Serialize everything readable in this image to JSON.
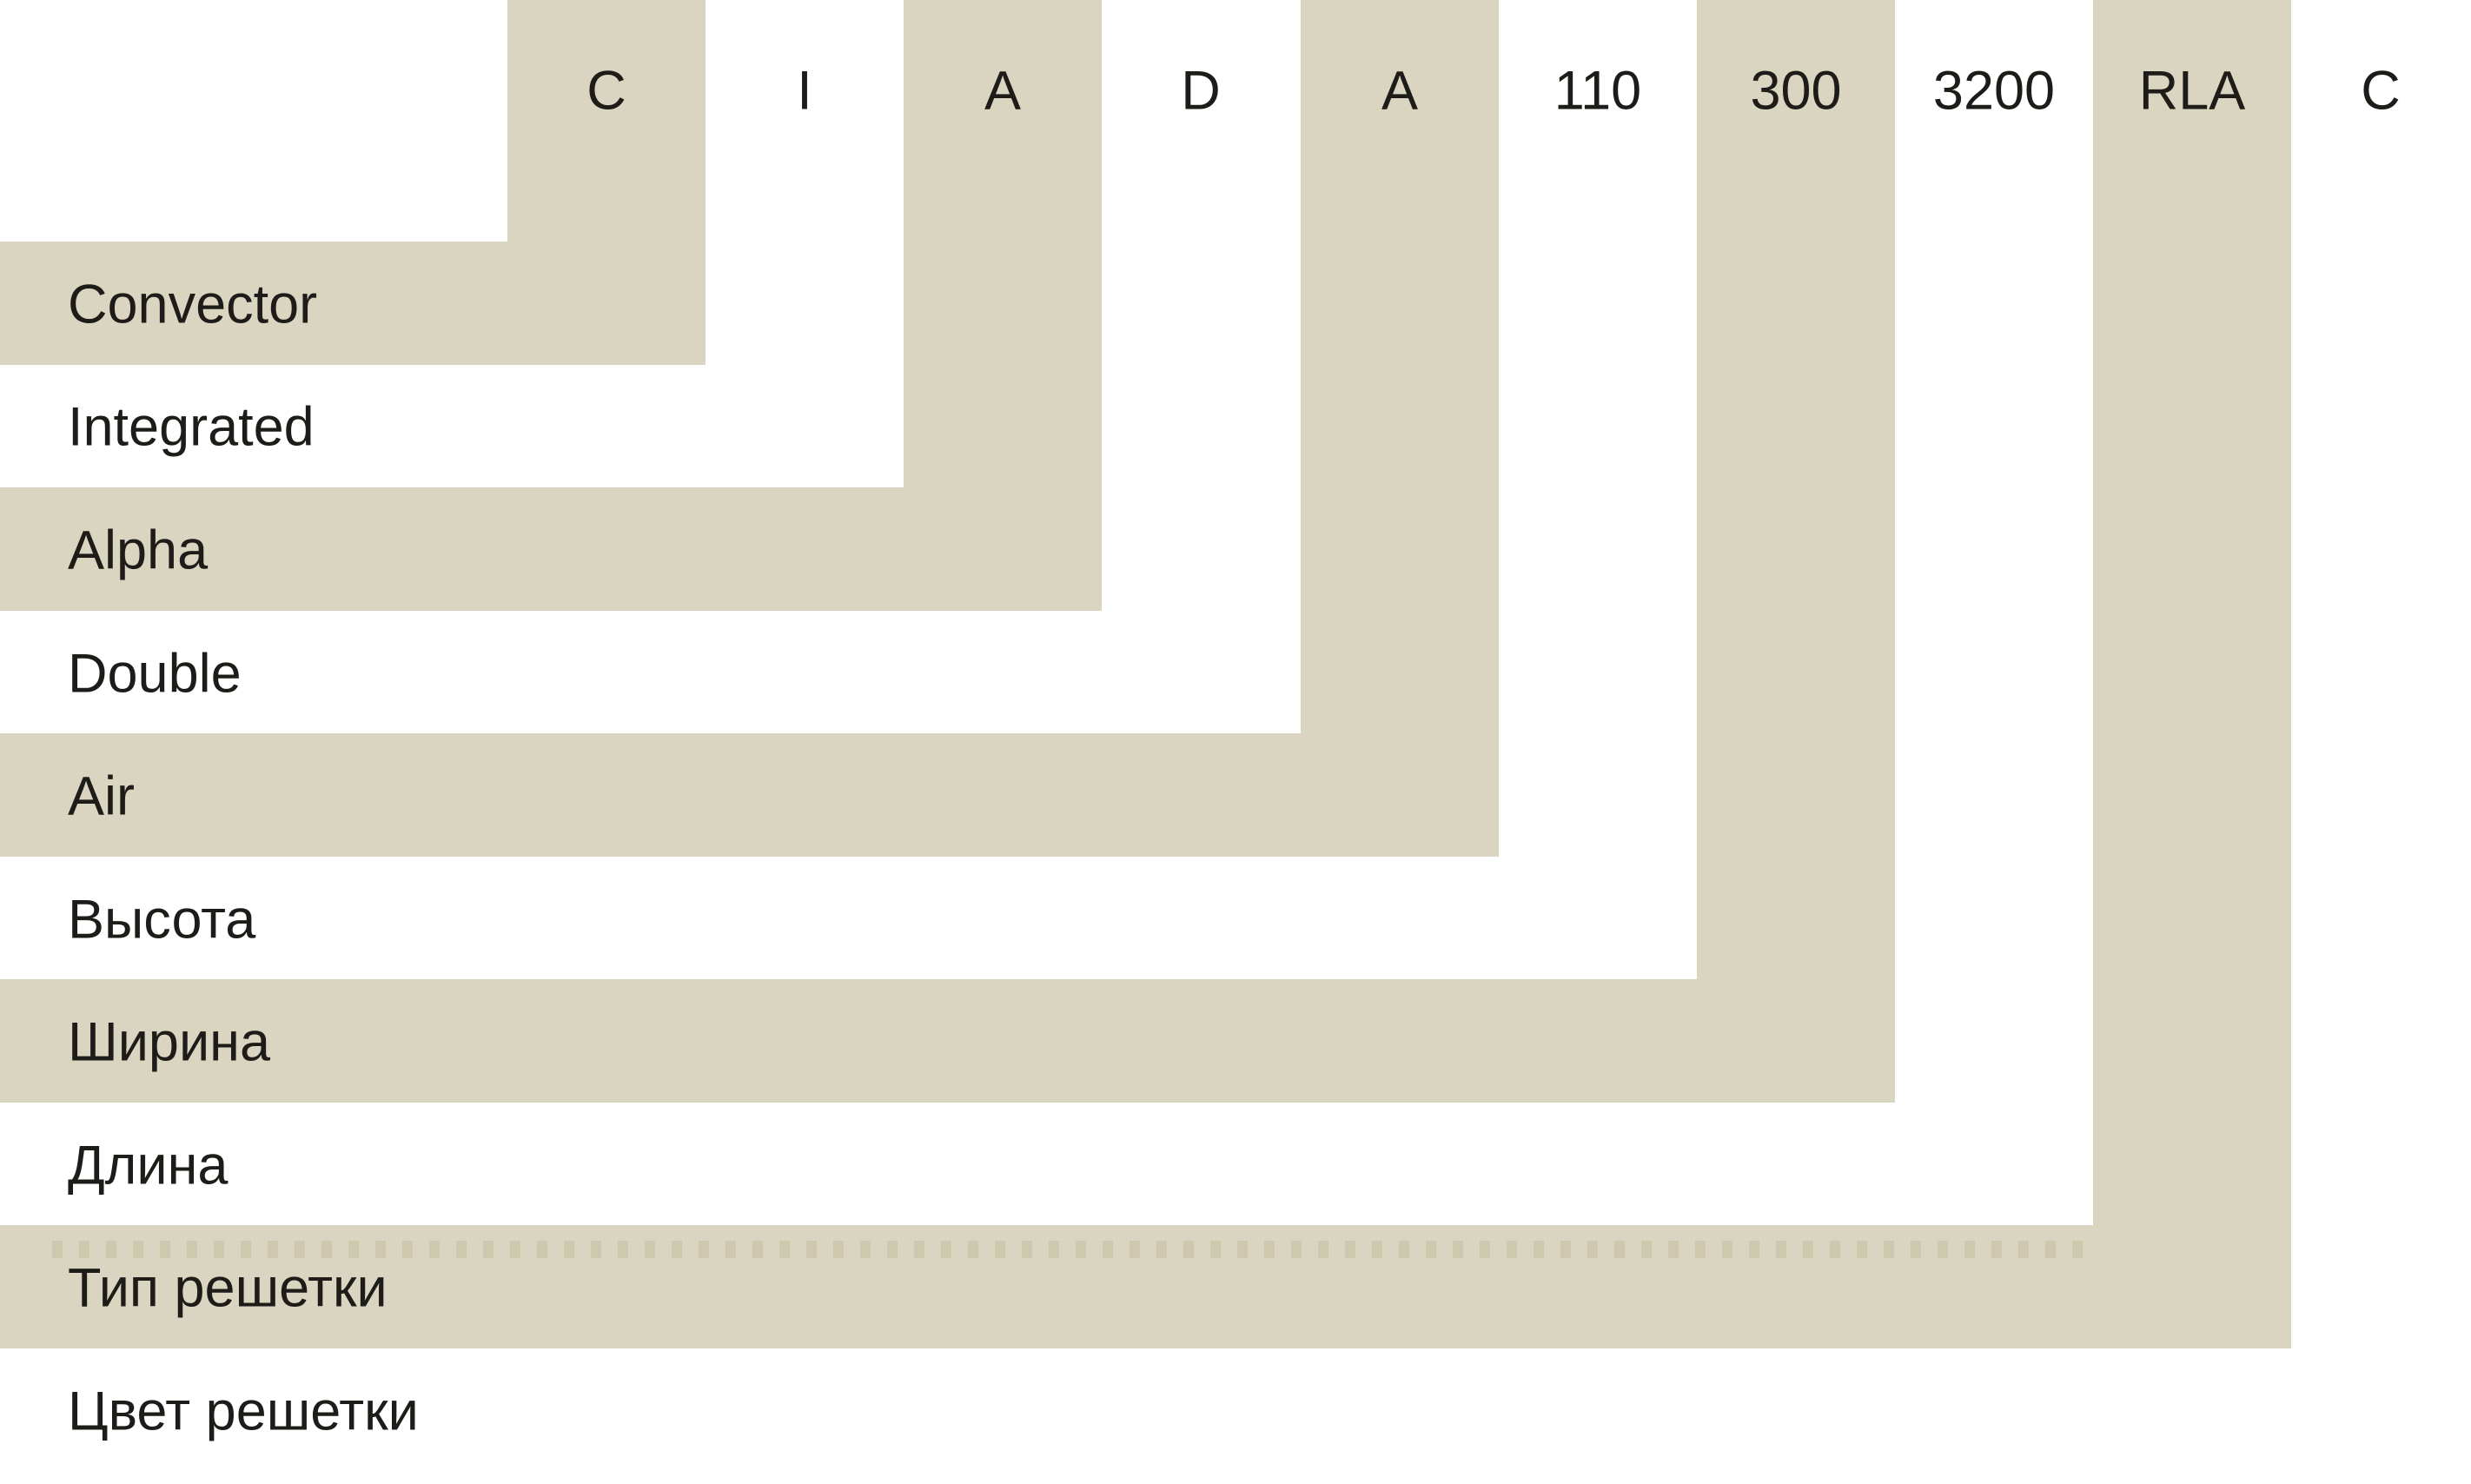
{
  "diagram": {
    "type": "product-code-breakdown",
    "segments": [
      {
        "code": "C",
        "label": "Convector"
      },
      {
        "code": "I",
        "label": "Integrated"
      },
      {
        "code": "A",
        "label": "Alpha"
      },
      {
        "code": "D",
        "label": "Double"
      },
      {
        "code": "A",
        "label": "Air"
      },
      {
        "code": "110",
        "label": "Высота"
      },
      {
        "code": "300",
        "label": "Ширина"
      },
      {
        "code": "3200",
        "label": "Длина"
      },
      {
        "code": "RLA",
        "label": "Тип решетки"
      },
      {
        "code": "C",
        "label": "Цвет решетки"
      }
    ]
  },
  "colors": {
    "band": "#dad5c1",
    "bg": "#ffffff",
    "text": "#1d1c18",
    "dots": "#c9c3a6"
  }
}
